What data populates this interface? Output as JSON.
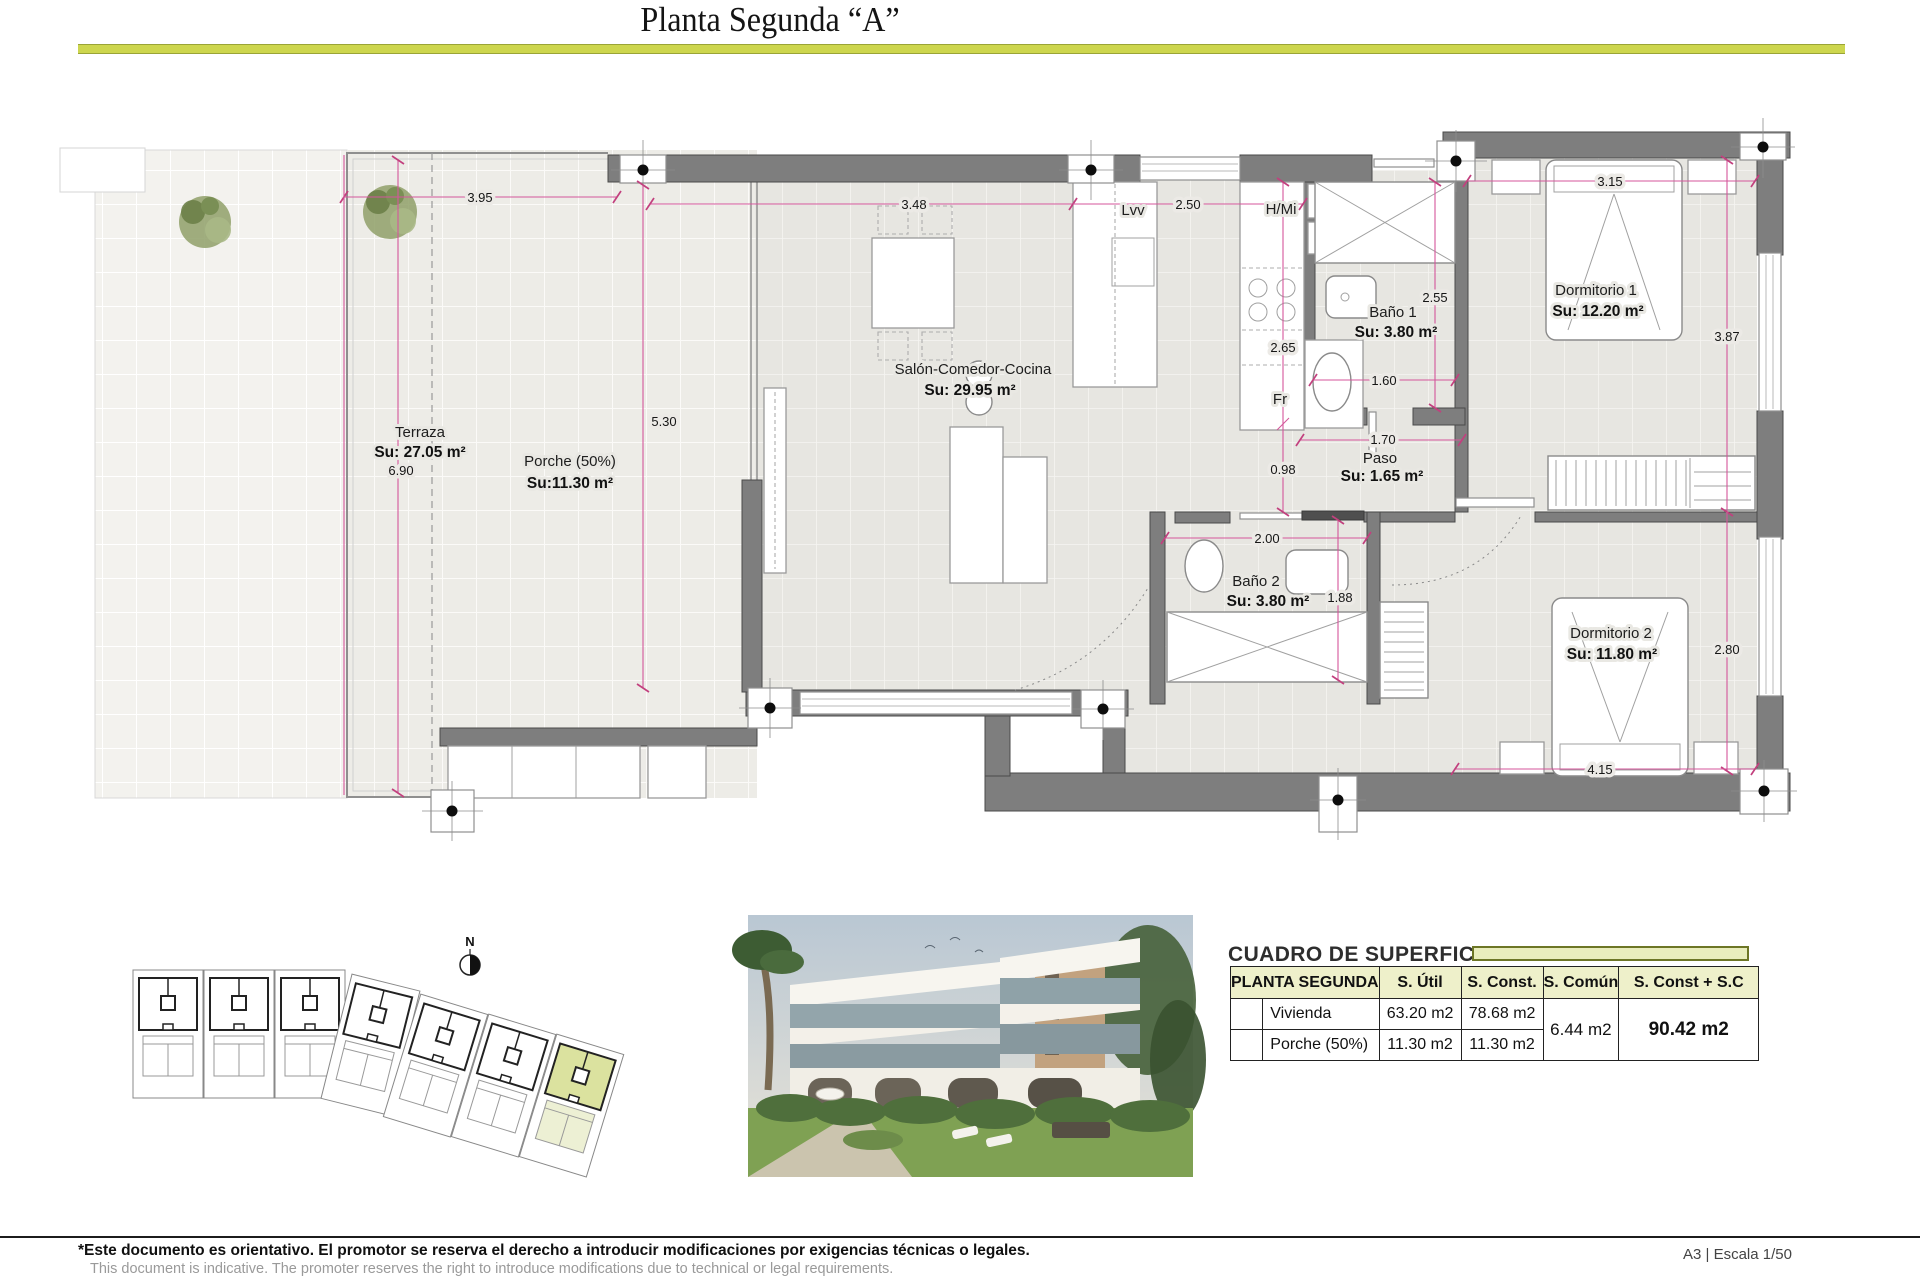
{
  "title": "Planta Segunda “A”",
  "plan": {
    "compass": "N",
    "rooms": {
      "terraza": {
        "name": "Terraza",
        "area": "Su: 27.05 m²"
      },
      "porche": {
        "name": "Porche (50%)",
        "area": "Su:11.30 m²"
      },
      "salon": {
        "name": "Salón-Comedor-Cocina",
        "area": "Su: 29.95 m²"
      },
      "bano1": {
        "name": "Baño 1",
        "area": "Su: 3.80 m²"
      },
      "bano2": {
        "name": "Baño 2",
        "area": "Su: 3.80 m²"
      },
      "paso": {
        "name": "Paso",
        "area": "Su: 1.65 m²"
      },
      "dorm1": {
        "name": "Dormitorio 1",
        "area": "Su: 12.20 m²"
      },
      "dorm2": {
        "name": "Dormitorio 2",
        "area": "Su: 11.80 m²"
      }
    },
    "appliances": {
      "dishwasher": "Lvv",
      "column": "H/Mi",
      "fridge": "Fr"
    },
    "dims": {
      "terraza_w": "3.95",
      "terraza_h": "6.90",
      "salon_w": "3.48",
      "salon_h": "5.30",
      "kitchen_w": "2.50",
      "kitchen_h": "2.65",
      "kitchen_low": "0.98",
      "bano1_h": "2.55",
      "bano1_w": "1.60",
      "paso_w": "1.70",
      "bano2_w": "2.00",
      "bano2_h": "1.88",
      "dorm1_w": "3.15",
      "dorm1_h": "3.87",
      "dorm2_h": "2.80",
      "dorm2_w": "4.15"
    }
  },
  "surfaces_table": {
    "title": "CUADRO DE SUPERFICIES",
    "columns": {
      "group": "PLANTA SEGUNDA",
      "util": "S. Útil",
      "const": "S. Const.",
      "comun": "S. Común",
      "total": "S. Const + S.C"
    },
    "rows": [
      {
        "label": "Vivienda",
        "util": "63.20 m2",
        "const": "78.68 m2"
      },
      {
        "label": "Porche (50%)",
        "util": "11.30 m2",
        "const": "11.30 m2"
      }
    ],
    "comun_value": "6.44 m2",
    "total_value": "90.42 m2"
  },
  "footer": {
    "note_es": "*Este documento es orientativo. El promotor se reserva el derecho a introducir modificaciones por exigencias técnicas o legales.",
    "note_en": "This document is indicative. The promoter reserves the right to introduce modifications due to technical or legal requirements.",
    "sheet": "A3 | Escala 1/50"
  },
  "colors": {
    "accent": "#cdd64e",
    "table_header": "#eef0ca",
    "wall": "#7e7e7e",
    "dimension": "#d4569b",
    "site_highlight": "#dbe29f"
  }
}
